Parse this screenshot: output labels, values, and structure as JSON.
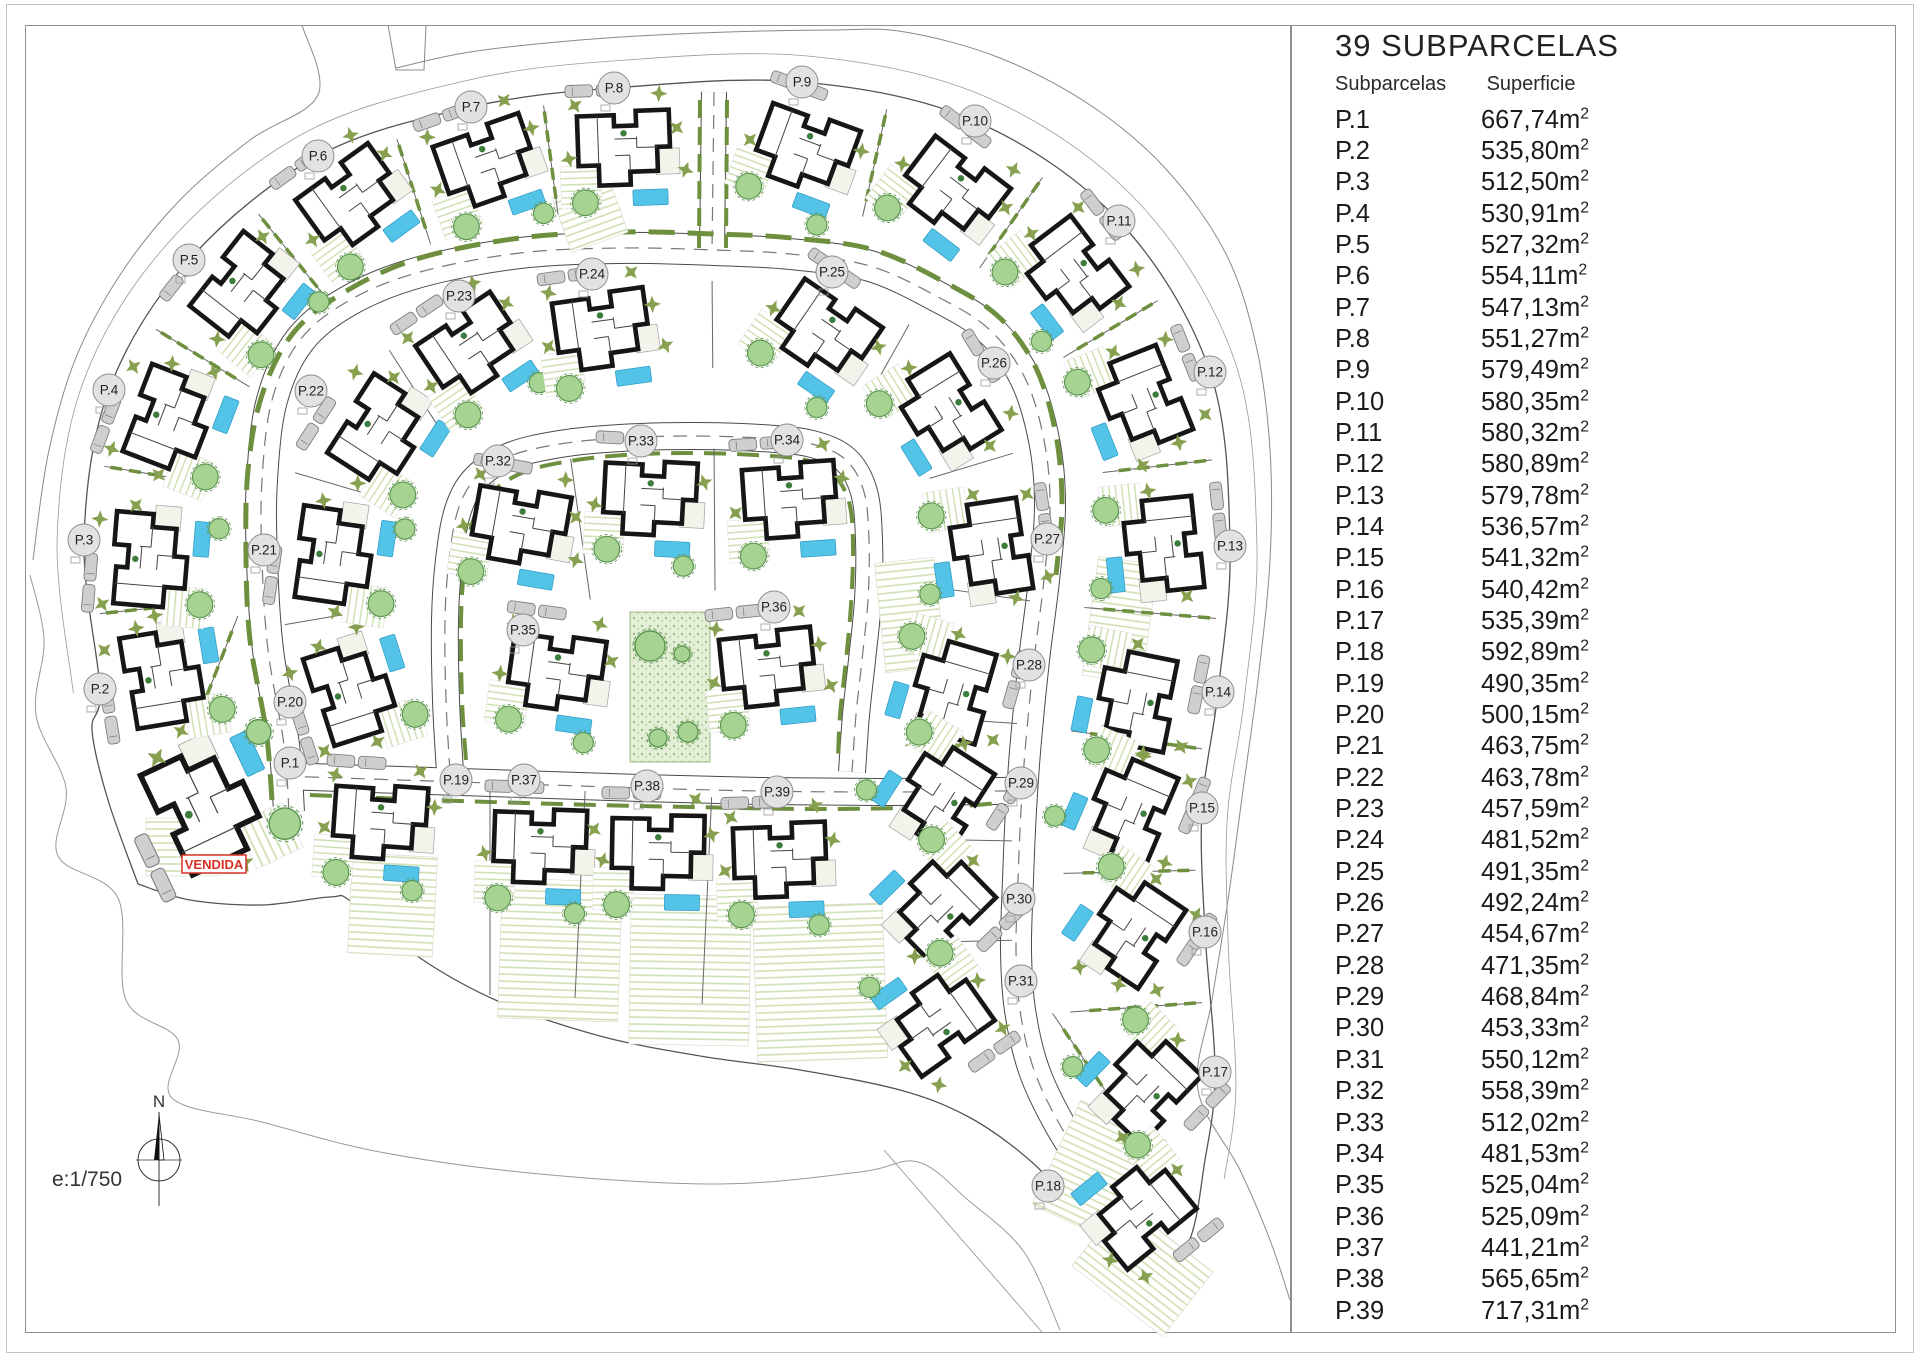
{
  "legend": {
    "title": "39 SUBPARCELAS",
    "col_parcel": "Subparcelas",
    "col_area": "Superficie",
    "unit_base": "m",
    "unit_exp": "2"
  },
  "annotations": {
    "sold_label": "VENDIDA",
    "north_label": "N",
    "scale_label": "e:1/750"
  },
  "colors": {
    "pool": "#53c3e8",
    "tree_fill": "#a6d392",
    "tree_stroke": "#5e9552",
    "star_tree": "#87a04f",
    "hedge": "#6e8f3e",
    "grass_hatch": "#cfe0b4",
    "plaza_bg": "#e3eed6",
    "plaza_dot": "#97bb77",
    "house_wall": "#161616",
    "carport": "#cfcfcf",
    "road_edge": "#4a4a4a",
    "boundary": "#8a8a8a",
    "label_fill": "#e2e2e2",
    "label_stroke": "#8d8d8d",
    "sold_red": "#d93025"
  },
  "parcels": [
    {
      "id": "P.1",
      "area": "667,74",
      "lx": 290,
      "ly": 763,
      "hx": 205,
      "hy": 807,
      "s": 1.12
    },
    {
      "id": "P.2",
      "area": "535,80",
      "lx": 100,
      "ly": 689,
      "hx": 163,
      "hy": 678
    },
    {
      "id": "P.3",
      "area": "512,50",
      "lx": 84,
      "ly": 540,
      "hx": 150,
      "hy": 560
    },
    {
      "id": "P.4",
      "area": "530,91",
      "lx": 109,
      "ly": 390,
      "hx": 170,
      "hy": 420
    },
    {
      "id": "P.5",
      "area": "527,32",
      "lx": 189,
      "ly": 260,
      "hx": 244,
      "hy": 290
    },
    {
      "id": "P.6",
      "area": "554,11",
      "lx": 318,
      "ly": 156,
      "hx": 352,
      "hy": 200
    },
    {
      "id": "P.7",
      "area": "547,13",
      "lx": 471,
      "ly": 107,
      "hx": 487,
      "hy": 163
    },
    {
      "id": "P.8",
      "area": "551,27",
      "lx": 614,
      "ly": 88,
      "hx": 624,
      "hy": 148
    },
    {
      "id": "P.9",
      "area": "579,49",
      "lx": 802,
      "ly": 82,
      "hx": 805,
      "hy": 150
    },
    {
      "id": "P.10",
      "area": "580,35",
      "lx": 975,
      "ly": 121,
      "hx": 952,
      "hy": 190
    },
    {
      "id": "P.11",
      "area": "580,32",
      "lx": 1119,
      "ly": 221,
      "hx": 1072,
      "hy": 272
    },
    {
      "id": "P.12",
      "area": "580,89",
      "lx": 1210,
      "ly": 372,
      "hx": 1142,
      "hy": 400
    },
    {
      "id": "P.13",
      "area": "579,78",
      "lx": 1230,
      "ly": 546,
      "hx": 1163,
      "hy": 545
    },
    {
      "id": "P.14",
      "area": "536,57",
      "lx": 1218,
      "ly": 692,
      "hx": 1136,
      "hy": 700
    },
    {
      "id": "P.15",
      "area": "541,32",
      "lx": 1202,
      "ly": 808,
      "hx": 1130,
      "hy": 808
    },
    {
      "id": "P.16",
      "area": "540,42",
      "lx": 1205,
      "ly": 932,
      "hx": 1133,
      "hy": 930
    },
    {
      "id": "P.17",
      "area": "535,39",
      "lx": 1215,
      "ly": 1072,
      "hx": 1146,
      "hy": 1086
    },
    {
      "id": "P.18",
      "area": "592,89",
      "lx": 1048,
      "ly": 1186,
      "hx": 1140,
      "hy": 1212
    },
    {
      "id": "P.19",
      "area": "490,35",
      "lx": 456,
      "ly": 780,
      "hx": 380,
      "hy": 822,
      "rot": 4
    },
    {
      "id": "P.20",
      "area": "500,15",
      "lx": 290,
      "ly": 702,
      "hx": 352,
      "hy": 692
    },
    {
      "id": "P.21",
      "area": "463,75",
      "lx": 264,
      "ly": 550,
      "hx": 334,
      "hy": 556
    },
    {
      "id": "P.22",
      "area": "463,78",
      "lx": 311,
      "ly": 391,
      "hx": 380,
      "hy": 432
    },
    {
      "id": "P.23",
      "area": "457,59",
      "lx": 459,
      "ly": 296,
      "hx": 472,
      "hy": 348
    },
    {
      "id": "P.24",
      "area": "481,52",
      "lx": 592,
      "ly": 274,
      "hx": 602,
      "hy": 330
    },
    {
      "id": "P.25",
      "area": "491,35",
      "lx": 832,
      "ly": 272,
      "hx": 824,
      "hy": 332
    },
    {
      "id": "P.26",
      "area": "492,24",
      "lx": 994,
      "ly": 363,
      "hx": 946,
      "hy": 410
    },
    {
      "id": "P.27",
      "area": "454,67",
      "lx": 1047,
      "ly": 539,
      "hx": 990,
      "hy": 548
    },
    {
      "id": "P.28",
      "area": "471,35",
      "lx": 1029,
      "ly": 665,
      "hx": 952,
      "hy": 690
    },
    {
      "id": "P.29",
      "area": "468,84",
      "lx": 1021,
      "ly": 783,
      "hx": 942,
      "hy": 795
    },
    {
      "id": "P.30",
      "area": "453,33",
      "lx": 1019,
      "ly": 899,
      "hx": 940,
      "hy": 906
    },
    {
      "id": "P.31",
      "area": "550,12",
      "lx": 1021,
      "ly": 981,
      "hx": 938,
      "hy": 1020
    },
    {
      "id": "P.32",
      "area": "558,39",
      "lx": 498,
      "ly": 461,
      "hx": 520,
      "hy": 526,
      "rot": 10
    },
    {
      "id": "P.33",
      "area": "512,02",
      "lx": 641,
      "ly": 441,
      "hx": 650,
      "hy": 498,
      "rot": 3
    },
    {
      "id": "P.34",
      "area": "481,53",
      "lx": 787,
      "ly": 440,
      "hx": 790,
      "hy": 500,
      "rot": -4
    },
    {
      "id": "P.35",
      "area": "525,04",
      "lx": 523,
      "ly": 630,
      "hx": 556,
      "hy": 672,
      "rot": 8
    },
    {
      "id": "P.36",
      "area": "525,09",
      "lx": 774,
      "ly": 607,
      "hx": 768,
      "hy": 668,
      "rot": -6
    },
    {
      "id": "P.37",
      "area": "441,21",
      "lx": 524,
      "ly": 780,
      "hx": 540,
      "hy": 846,
      "rot": 2
    },
    {
      "id": "P.38",
      "area": "565,65",
      "lx": 647,
      "ly": 786,
      "hx": 658,
      "hy": 852,
      "rot": 1
    },
    {
      "id": "P.39",
      "area": "717,31",
      "lx": 777,
      "ly": 792,
      "hx": 780,
      "hy": 860,
      "rot": -2
    }
  ]
}
